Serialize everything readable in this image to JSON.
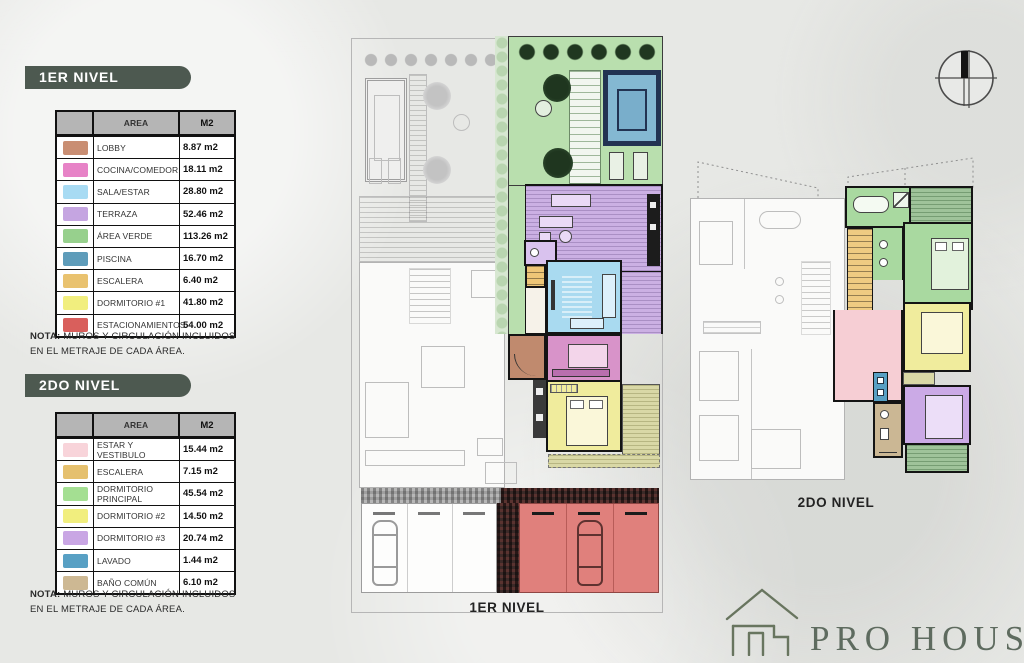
{
  "level1": {
    "badge": "1ER NIVEL",
    "plan_label": "1ER NIVEL",
    "table": {
      "header": {
        "area": "AREA",
        "m2": "M2"
      },
      "rows": [
        {
          "color": "#c98e73",
          "area": "LOBBY",
          "m2": "8.87 m2"
        },
        {
          "color": "#e783c7",
          "area": "COCINA/COMEDOR",
          "m2": "18.11 m2"
        },
        {
          "color": "#a8dbf3",
          "area": "SALA/ESTAR",
          "m2": "28.80 m2"
        },
        {
          "color": "#c5a5e1",
          "area": "TERRAZA",
          "m2": "52.46 m2"
        },
        {
          "color": "#97d08d",
          "area": "ÁREA VERDE",
          "m2": "113.26 m2"
        },
        {
          "color": "#5e9cba",
          "area": "PISCINA",
          "m2": "16.70 m2"
        },
        {
          "color": "#e9c26f",
          "area": "ESCALERA",
          "m2": "6.40 m2"
        },
        {
          "color": "#f1ee7e",
          "area": "DORMITORIO #1",
          "m2": "41.80 m2"
        },
        {
          "color": "#d95f5c",
          "area": "ESTACIONAMIENTOS",
          "m2": "54.00 m2"
        }
      ]
    },
    "note_label": "NOTA:",
    "note_text": "MUROS Y CIRCULACIÓN INCLUIDOS EN EL METRAJE DE CADA ÁREA."
  },
  "level2": {
    "badge": "2DO NIVEL",
    "plan_label": "2DO NIVEL",
    "table": {
      "header": {
        "area": "AREA",
        "m2": "M2"
      },
      "rows": [
        {
          "color": "#f8d4da",
          "area": "ESTAR Y VESTIBULO",
          "m2": "15.44 m2"
        },
        {
          "color": "#e5c06e",
          "area": "ESCALERA",
          "m2": "7.15 m2"
        },
        {
          "color": "#a4df92",
          "area": "DORMITORIO PRINCIPAL",
          "m2": "45.54 m2"
        },
        {
          "color": "#f1ee7e",
          "area": "DORMITORIO #2",
          "m2": "14.50 m2"
        },
        {
          "color": "#c9a6e4",
          "area": "DORMITORIO #3",
          "m2": "20.74 m2"
        },
        {
          "color": "#58a0c4",
          "area": "LAVADO",
          "m2": "1.44 m2"
        },
        {
          "color": "#cdb893",
          "area": "BAÑO COMÚN",
          "m2": "6.10 m2"
        }
      ]
    },
    "note_label": "NOTA:",
    "note_text": "MUROS Y CIRCULACIÓN INCLUIDOS EN EL METRAJE DE CADA ÁREA."
  },
  "plan_fills": {
    "area_verde": "#b9dfae",
    "piscina": "#84b8d2",
    "terraza": "#cbb0e3",
    "sala_estar": "#a9daf0",
    "cocina_comedor": "#d893c9",
    "lobby": "#c08a6e",
    "escalera1": "#eec677",
    "dormitorio1": "#f0ec9d",
    "estacionamientos": "#e0807c",
    "estar_vestibulo": "#f6ced4",
    "escalera2": "#eecb82",
    "dormitorio_principal": "#a9d9a0",
    "dormitorio2": "#f0ec9d",
    "dormitorio3": "#cbaae6",
    "lavado": "#58a0c4",
    "bano_comun": "#cbb794",
    "balcon_verde": "#9fc39a",
    "terraza_olivo": "#d9d8a6",
    "bano_dormitorio1": "#3a3a3a"
  },
  "logo": {
    "name": "PRO HOUSE"
  },
  "icons": {
    "compass": "north-compass",
    "logo_house": "house-outline"
  }
}
